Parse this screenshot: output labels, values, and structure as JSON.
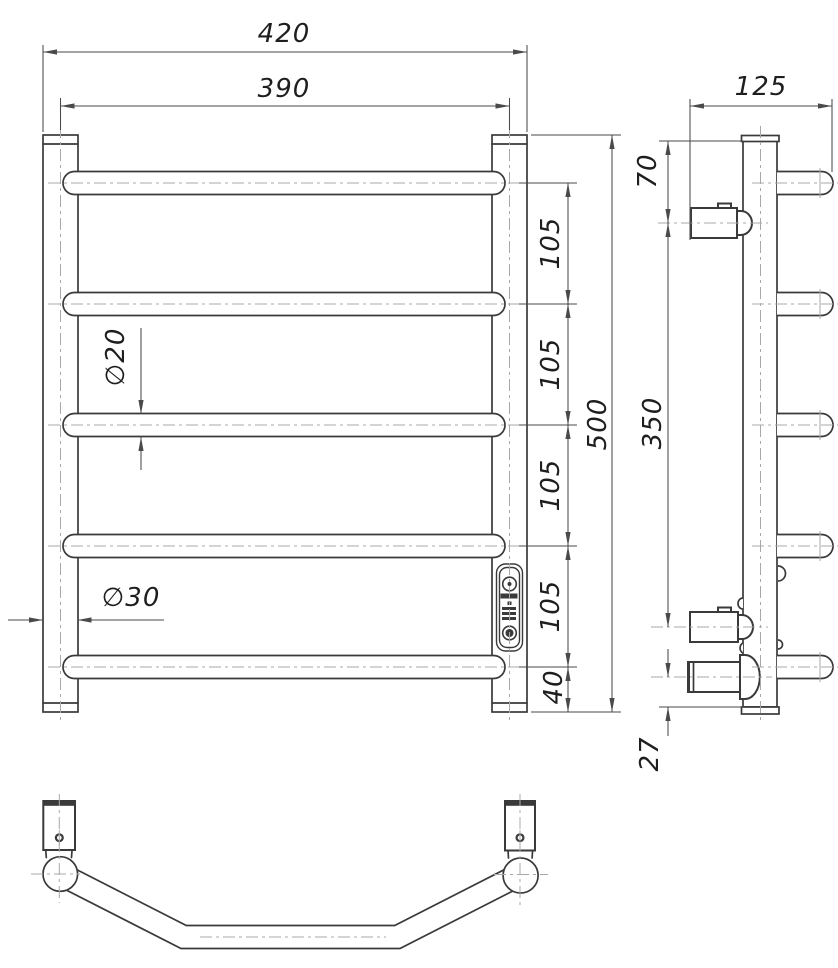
{
  "colors": {
    "line": "#3a3a3a",
    "dim": "#4a4a4a",
    "cline": "#a8a8a8",
    "text": "#1e1e1e",
    "bg": "#ffffff"
  },
  "dims": {
    "front_overall_width": "420",
    "front_rail_center_width": "390",
    "front_overall_height": "500",
    "front_rung_spacing_1": "105",
    "front_rung_spacing_2": "105",
    "front_rung_spacing_3": "105",
    "front_rung_spacing_4": "105",
    "front_bottom_offset": "40",
    "rung_diameter": "∅20",
    "post_diameter": "∅30",
    "side_depth": "125",
    "side_top_to_bracket": "70",
    "side_bracket_spacing": "350",
    "side_bottom_offset": "27"
  }
}
